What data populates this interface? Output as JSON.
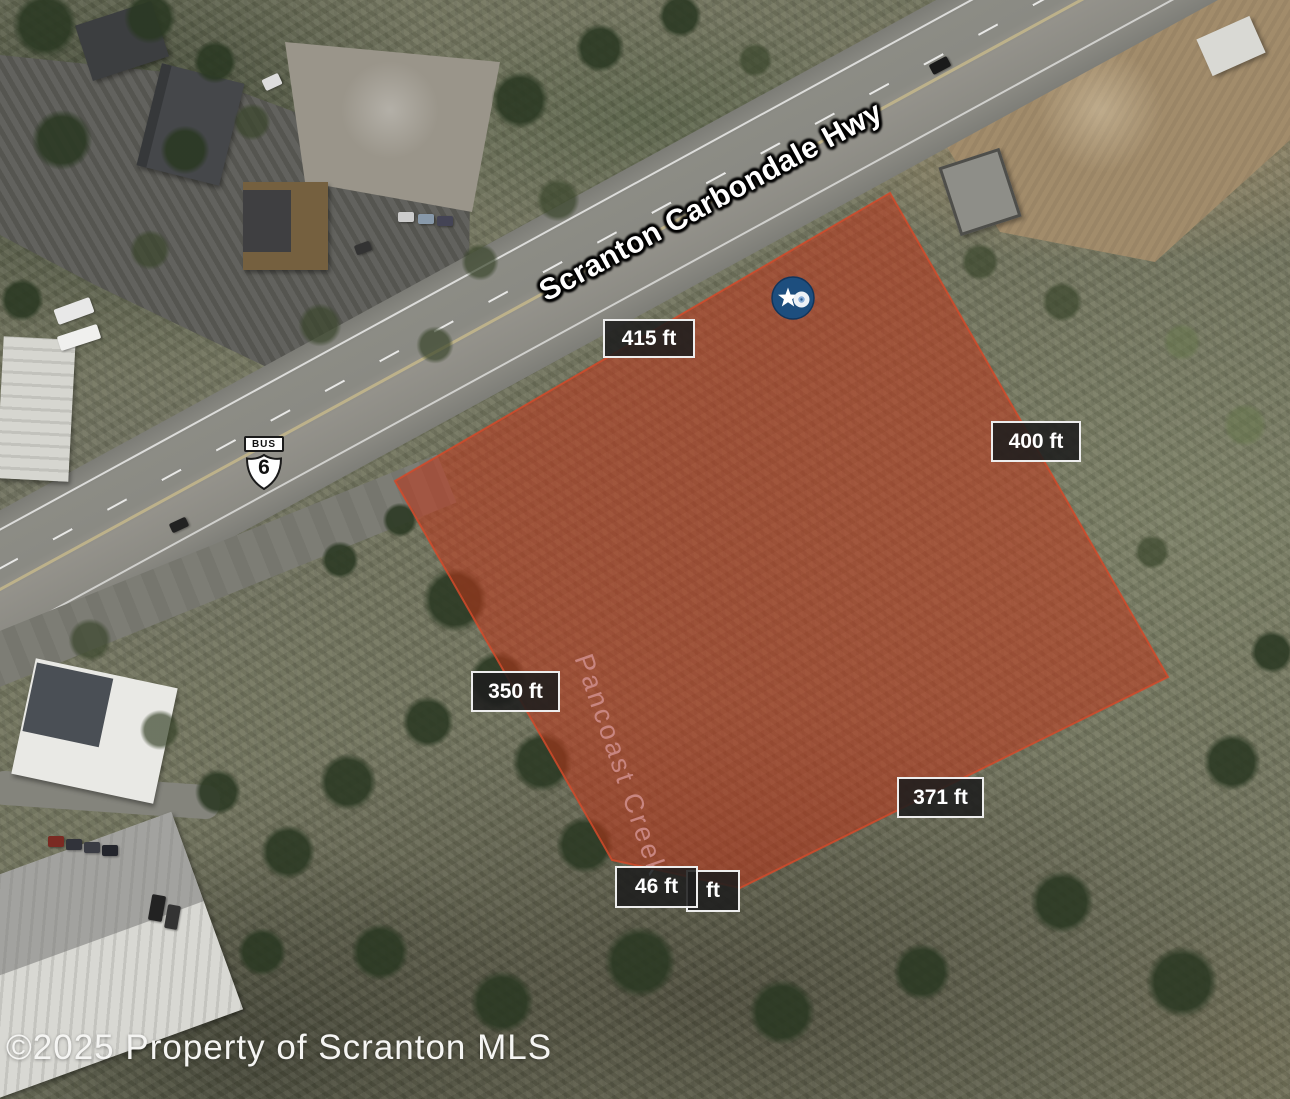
{
  "map": {
    "type": "satellite-aerial",
    "watermark": "©2025 Property of Scranton MLS",
    "road": {
      "name": "Scranton Carbondale Hwy"
    },
    "route_shield": {
      "banner": "BUS",
      "number": "6"
    },
    "creek": {
      "name": "Pancoast Creek"
    },
    "marker": {
      "kind": "street-view-star-marker"
    },
    "parcel": {
      "shape": "irregular-pentagon",
      "measurements": [
        {
          "side": "top",
          "text": "415 ft"
        },
        {
          "side": "right",
          "text": "400 ft"
        },
        {
          "side": "left",
          "text": "350 ft"
        },
        {
          "side": "bottom-right",
          "text": "371 ft"
        },
        {
          "side": "bottom",
          "text": "46 ft"
        },
        {
          "side": "bottom-partial-hidden",
          "text": "ft"
        }
      ]
    },
    "colors": {
      "parcel_fill": "#c23317",
      "parcel_stroke": "#d24a2a",
      "label_bg": "rgba(30,30,30,0.88)",
      "label_border": "#ededed",
      "label_text": "#ffffff",
      "marker_blue": "#1d4e7e",
      "creek_text": "#cfe2f7",
      "road_text": "#ffffff"
    }
  }
}
